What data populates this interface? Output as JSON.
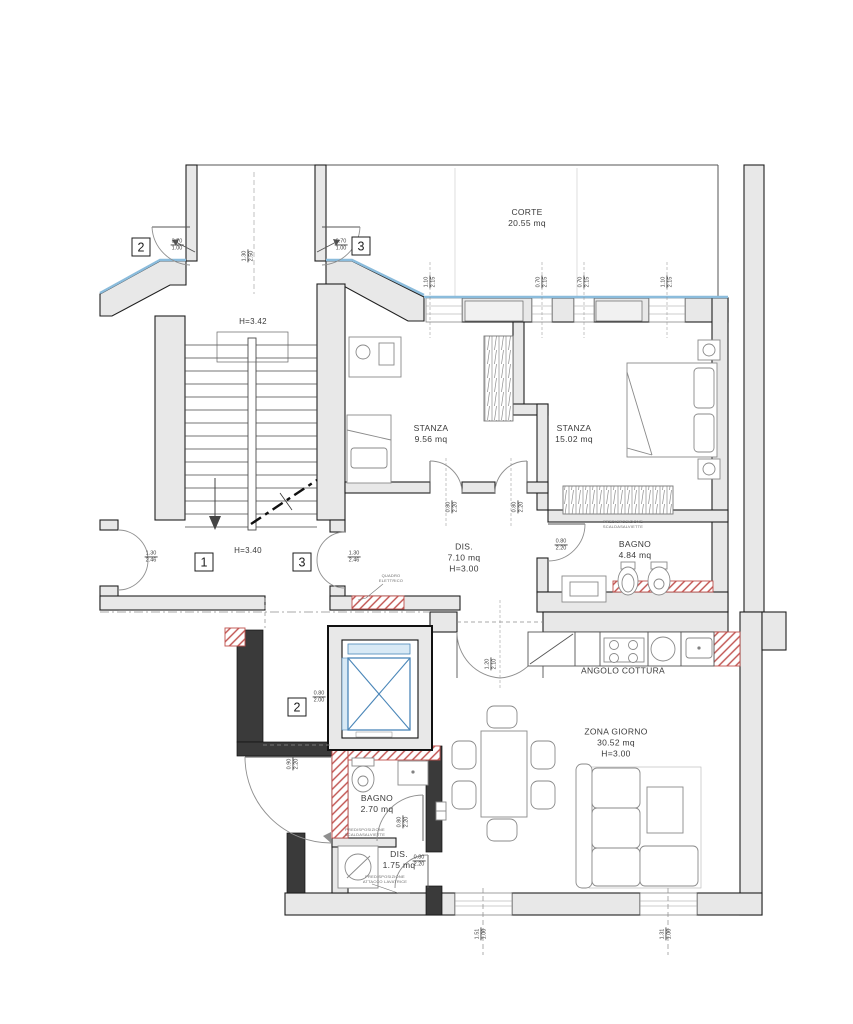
{
  "plan": {
    "labels": [
      {
        "text": "CORTE\n20.55 mq"
      },
      {
        "text": "H=3.42"
      },
      {
        "text": "STANZA\n9.56 mq"
      },
      {
        "text": "STANZA\n15.02 mq"
      },
      {
        "text": "DIS.\n7.10 mq\nH=3.00"
      },
      {
        "text": "BAGNO\n4.84 mq"
      },
      {
        "text": "H=3.40"
      },
      {
        "text": "ANGOLO COTTURA"
      },
      {
        "text": "ZONA GIORNO\n30.52 mq\nH=3.00"
      },
      {
        "text": "BAGNO\n2.70 mq"
      },
      {
        "text": "DIS.\n1.75 mq"
      }
    ],
    "markers": [
      {
        "n": "2"
      },
      {
        "n": "3"
      },
      {
        "n": "1"
      },
      {
        "n": "3"
      },
      {
        "n": "2"
      }
    ],
    "dimensions": [
      {
        "w": "3.70",
        "h": "1.00"
      },
      {
        "w": "0.70",
        "h": "1.00"
      },
      {
        "w": "1.30",
        "h": "2.50"
      },
      {
        "w": "1.10",
        "h": "2.15"
      },
      {
        "w": "0.70",
        "h": "2.15"
      },
      {
        "w": "0.70",
        "h": "2.15"
      },
      {
        "w": "1.10",
        "h": "2.15"
      },
      {
        "w": "1.30",
        "h": "2.46"
      },
      {
        "w": "1.30",
        "h": "2.46"
      },
      {
        "w": "0.80",
        "h": "2.20"
      },
      {
        "w": "0.80",
        "h": "2.20"
      },
      {
        "w": "0.80",
        "h": "2.20"
      },
      {
        "w": "0.80",
        "h": "2.00"
      },
      {
        "w": "1.20",
        "h": "2.10"
      },
      {
        "w": "0.90",
        "h": "2.20"
      },
      {
        "w": "0.80",
        "h": "2.20"
      },
      {
        "w": "0.80",
        "h": "2.20"
      },
      {
        "w": "1.51",
        "h": "1.00"
      },
      {
        "w": "1.31",
        "h": "1.00"
      }
    ],
    "annotations": [
      {
        "text": "PREDISPOSIZIONE\nSCALDASALVIETTE"
      },
      {
        "text": "QUADRO\nELETTRICO"
      },
      {
        "text": "PREDISPOSIZIONE\nSCALDASALVIETTE"
      },
      {
        "text": "PREDISPOSIZIONE\nATTACCO LAVATRICE"
      }
    ],
    "colors": {
      "wall_fill": "#e8e8e8",
      "line": "#222222",
      "new_wall_red": "#c0504d",
      "glass_blue": "#8bbcdc",
      "elevator_blue": "#4a86b8"
    }
  }
}
